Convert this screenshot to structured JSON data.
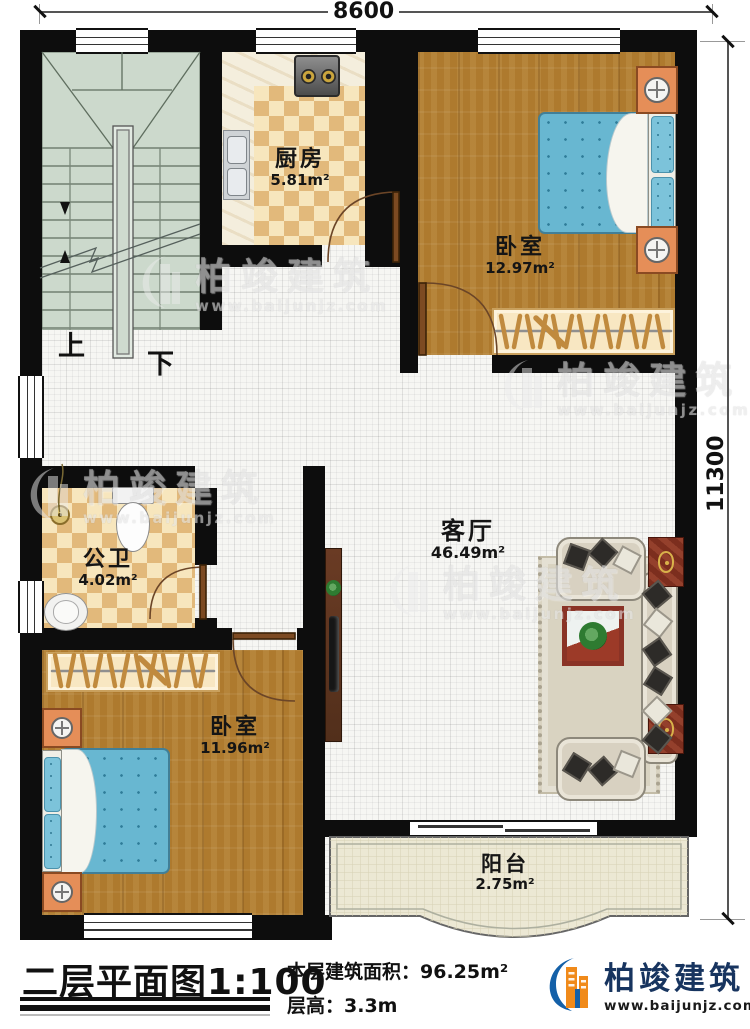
{
  "dimensions": {
    "top": "8600",
    "right": "11300"
  },
  "rooms": {
    "kitchen": {
      "name": "厨房",
      "area": "5.81m²"
    },
    "bedroom_top": {
      "name": "卧室",
      "area": "12.97m²"
    },
    "bathroom": {
      "name": "公卫",
      "area": "4.02m²"
    },
    "living": {
      "name": "客厅",
      "area": "46.49m²"
    },
    "bedroom_bottom": {
      "name": "卧室",
      "area": "11.96m²"
    },
    "balcony": {
      "name": "阳台",
      "area": "2.75m²"
    }
  },
  "stairs": {
    "up": "上",
    "down": "下"
  },
  "watermark": {
    "brand": "柏竣建筑",
    "website": "www.baijunjz.com"
  },
  "footer": {
    "plan_title": "二层平面图",
    "scale": "1:100",
    "area_label": "本层建筑面积：",
    "area_value": "96.25m²",
    "height_label": "层高：",
    "height_value": "3.3m",
    "brand": "柏竣建筑",
    "website": "www.baijunjz.com"
  },
  "colors": {
    "wall": "#0d0d0d",
    "wood_floor": "#ae7a2e",
    "tile_check": "#e2b97b",
    "stair_floor": "#ccd9cc",
    "bed": "#68b7d1",
    "brand_blue": "#1460a8",
    "brand_orange": "#f08a1a"
  }
}
